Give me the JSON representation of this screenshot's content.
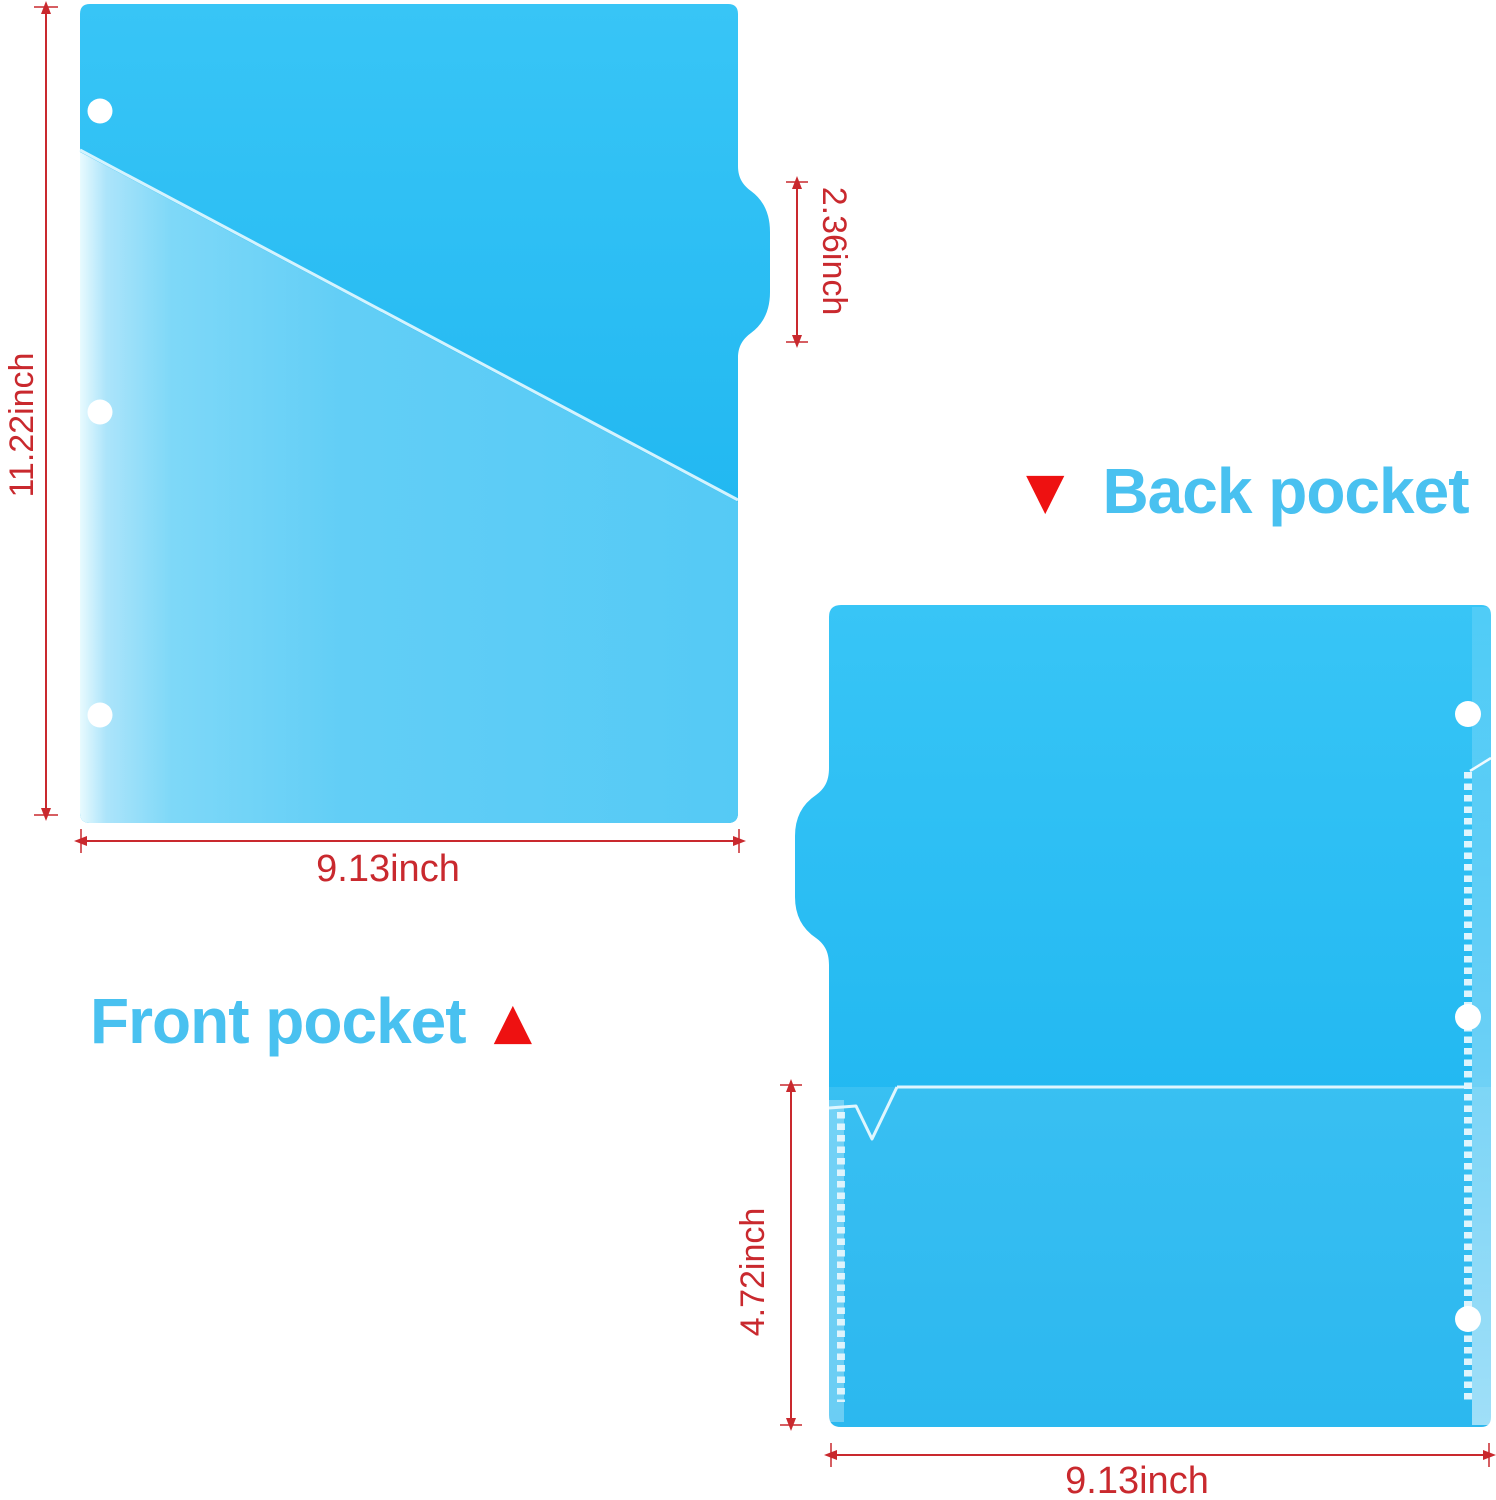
{
  "front_view": {
    "caption": "Front pocket",
    "marker": "▲",
    "height": "11.22inch",
    "width": "9.13inch",
    "tab_height": "2.36inch"
  },
  "back_view": {
    "caption": "Back pocket",
    "marker": "▼",
    "pocket_height": "4.72inch",
    "width": "9.13inch"
  },
  "colors": {
    "folder_blue_top": "#38c5f6",
    "folder_blue_bottom": "#14b0ee",
    "pocket_blue": "#62cef6",
    "seam_white": "#ffffff",
    "edge_line": "#ddf6fe",
    "dimension_red": "#c9292e",
    "marker_red": "#ee1111",
    "caption_blue": "#49c1f0"
  }
}
